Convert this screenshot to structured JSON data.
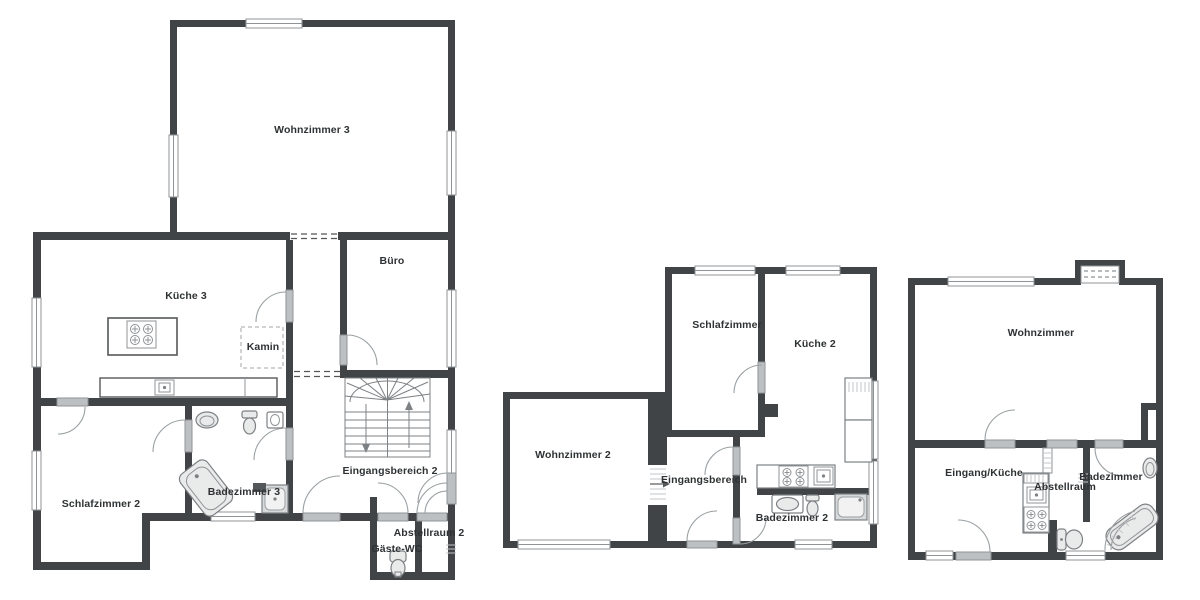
{
  "document": {
    "type": "Grundriss / floor plan",
    "background": "#ffffff"
  },
  "colors": {
    "wall": "#414447",
    "door_leaf": "#bdc0c2",
    "window_frame": "#8f9396",
    "fixture_outline": "#7d8184",
    "text": "#2f3234"
  },
  "plans": [
    {
      "id": "plan-left",
      "rooms": [
        {
          "id": "wohnzimmer-3",
          "label": "Wohnzimmer 3",
          "x": 312,
          "y": 130
        },
        {
          "id": "kueche-3",
          "label": "Küche 3",
          "x": 186,
          "y": 296
        },
        {
          "id": "buero",
          "label": "Büro",
          "x": 392,
          "y": 261
        },
        {
          "id": "kamin",
          "label": "Kamin",
          "x": 263,
          "y": 347
        },
        {
          "id": "schlafzimmer-2",
          "label": "Schlafzimmer 2",
          "x": 101,
          "y": 504
        },
        {
          "id": "badezimmer-3",
          "label": "Badezimmer 3",
          "x": 244,
          "y": 492
        },
        {
          "id": "eingangsbereich-2",
          "label": "Eingangsbereich 2",
          "x": 390,
          "y": 471
        },
        {
          "id": "abstellraum-2",
          "label": "Abstellraum 2",
          "x": 429,
          "y": 533
        },
        {
          "id": "gaeste-wc",
          "label": "Gäste-WC",
          "x": 397,
          "y": 549
        }
      ]
    },
    {
      "id": "plan-middle",
      "rooms": [
        {
          "id": "schlafzimmer",
          "label": "Schlafzimmer",
          "x": 727,
          "y": 325
        },
        {
          "id": "kueche-2",
          "label": "Küche 2",
          "x": 815,
          "y": 344
        },
        {
          "id": "wohnzimmer-2",
          "label": "Wohnzimmer 2",
          "x": 573,
          "y": 455
        },
        {
          "id": "eingangsbereich",
          "label": "Eingangsbereich",
          "x": 704,
          "y": 480
        },
        {
          "id": "badezimmer-2",
          "label": "Badezimmer 2",
          "x": 792,
          "y": 518
        }
      ]
    },
    {
      "id": "plan-right",
      "rooms": [
        {
          "id": "wohnzimmer",
          "label": "Wohnzimmer",
          "x": 1041,
          "y": 333
        },
        {
          "id": "eingang-kueche",
          "label": "Eingang/Küche",
          "x": 984,
          "y": 473
        },
        {
          "id": "abstellraum",
          "label": "Abstellraum",
          "x": 1065,
          "y": 487
        },
        {
          "id": "badezimmer",
          "label": "Badezimmer",
          "x": 1111,
          "y": 477
        }
      ]
    }
  ]
}
